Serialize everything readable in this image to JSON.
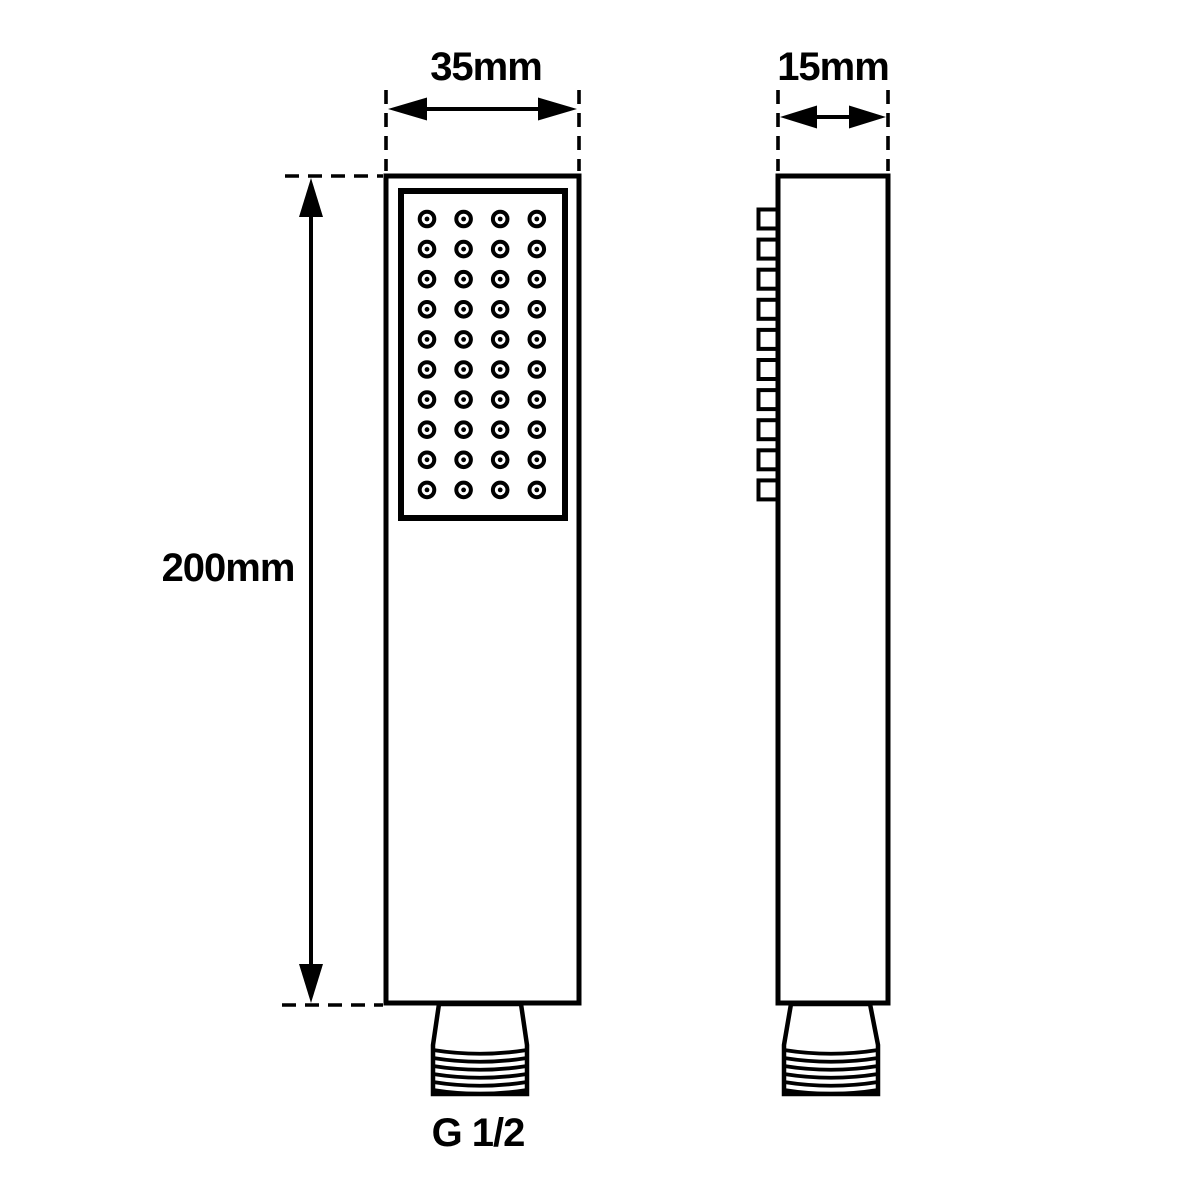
{
  "page": {
    "background": "#ffffff",
    "ink": "#000000"
  },
  "drawing": {
    "type": "technical-dimension-drawing",
    "subject": "handheld shower head, front and side views",
    "front_view": {
      "width_dimension": "35mm",
      "height_dimension": "200mm",
      "connector_label": "G 1/2",
      "nozzle_columns": 4,
      "nozzle_rows": 10,
      "nozzle_count": 40,
      "thread_ridge_count": 6
    },
    "side_view": {
      "depth_dimension": "15mm",
      "nozzle_bump_count": 10,
      "thread_ridge_count": 6
    }
  }
}
